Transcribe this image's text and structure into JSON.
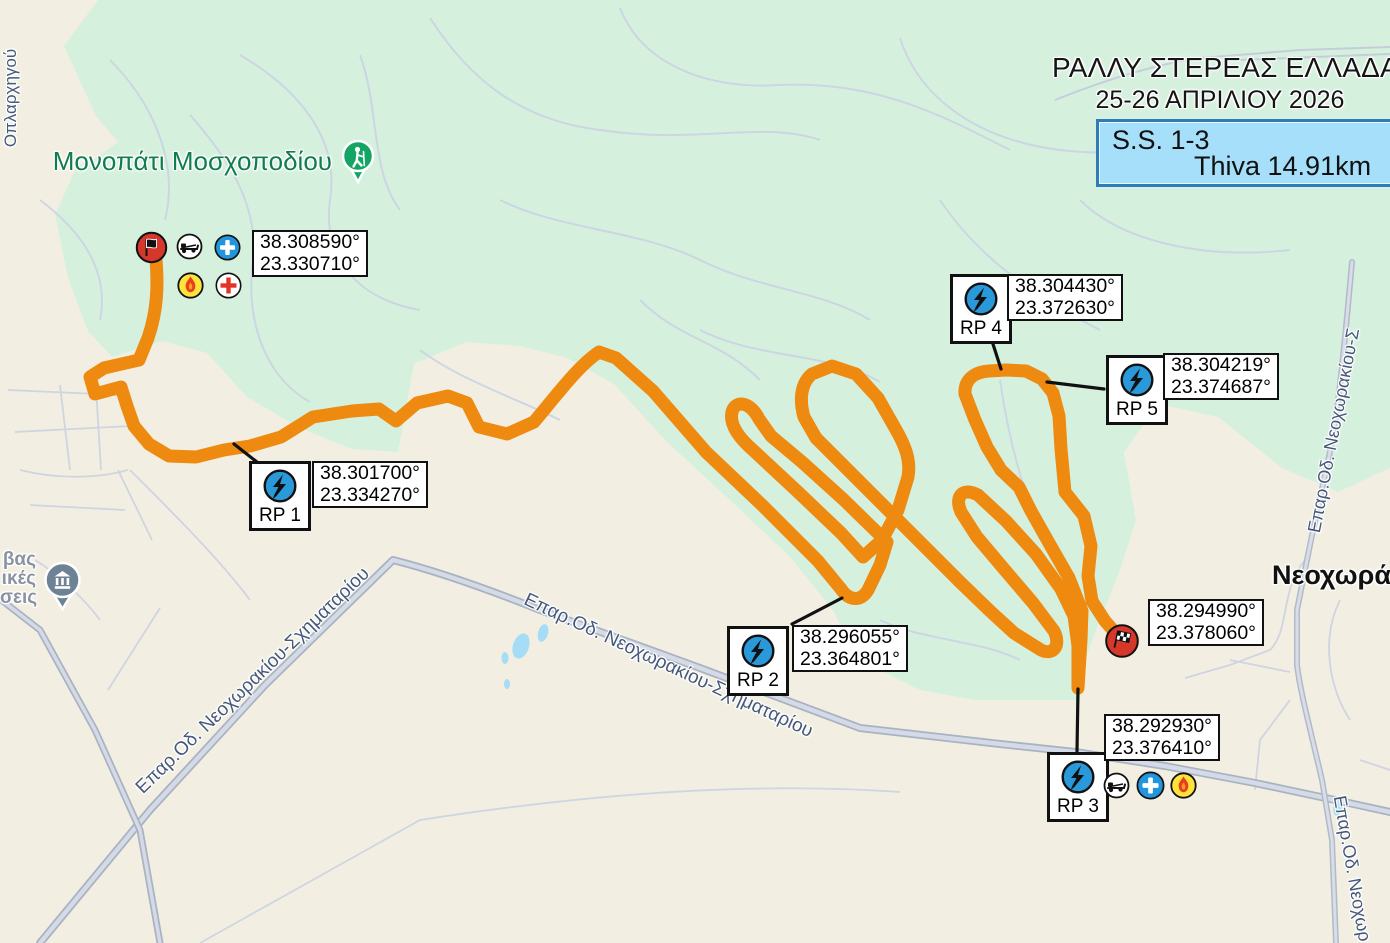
{
  "header": {
    "title_line1": "ΡΑΛΛΥ ΣΤΕΡΕΑΣ ΕΛΛΑΔΑΣ",
    "title_line2": "25-26 ΑΠΡΙΛΙΟΥ 2026",
    "stage_label": "S.S. 1-3",
    "stage_distance": "Thiva 14.91km"
  },
  "labels": {
    "trail": "Μονοπάτι Μοσχοποδίου",
    "village": "Νεοχωράκι",
    "town_frag1": "βας",
    "town_frag2": "ικές",
    "town_frag3": "σεις",
    "street_vertical": "Οπλαρχηγού",
    "road_sw": "Επαρ.Οδ. Νεοχωρακίου-Σχηματαρίου",
    "road_mid": "Επαρ.Οδ. Νεοχωρακίου-Σχηματαρίου",
    "road_ne": "Επαρ.Οδ. Νεοχωρακίου-Σ",
    "road_se": "Επαρ.Οδ. Νεοχωρ"
  },
  "markers": {
    "start": {
      "coord1": "38.308590°",
      "coord2": "23.330710°"
    },
    "finish": {
      "coord1": "38.294990°",
      "coord2": "23.378060°"
    },
    "rp": [
      {
        "label": "RP 1",
        "coord1": "38.301700°",
        "coord2": "23.334270°"
      },
      {
        "label": "RP 2",
        "coord1": "38.296055°",
        "coord2": "23.364801°"
      },
      {
        "label": "RP 3",
        "coord1": "38.292930°",
        "coord2": "23.376410°"
      },
      {
        "label": "RP 4",
        "coord1": "38.304430°",
        "coord2": "23.372630°"
      },
      {
        "label": "RP 5",
        "coord1": "38.304219°",
        "coord2": "23.374687°"
      }
    ]
  },
  "colors": {
    "route_orange": "#ee8a10",
    "forest_green": "#d6f0de",
    "land_beige": "#f2efe2",
    "water_blue": "#a6dcf5",
    "stage_box_fill": "#a5dff9",
    "stage_box_border": "#2f7cb8",
    "radio_icon_blue": "#2a99da",
    "marker_red": "#d6372b",
    "fire_yellow": "#ffe33b",
    "trail_pin_green": "#12a563"
  }
}
